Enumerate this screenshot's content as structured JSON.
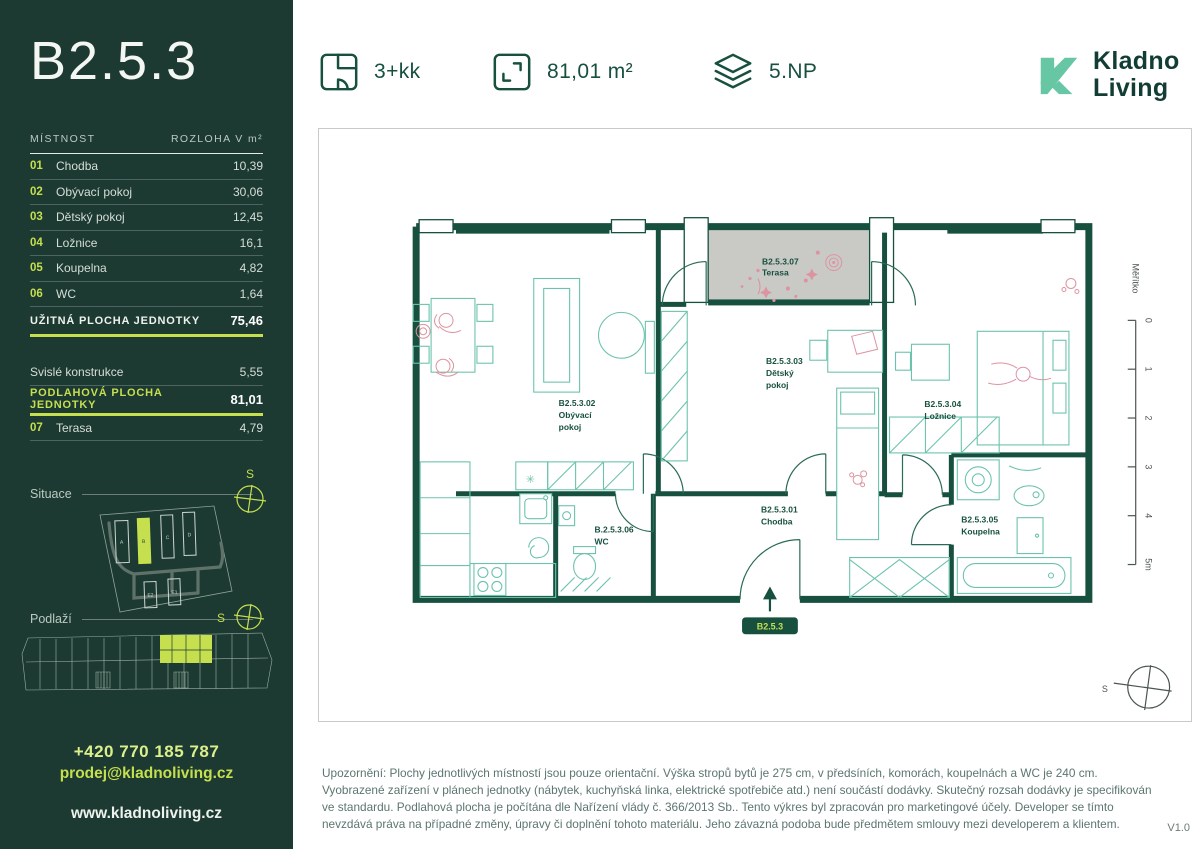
{
  "sidebar": {
    "unit_title": "B2.5.3",
    "table": {
      "col_room": "MÍSTNOST",
      "col_area": "ROZLOHA V m²",
      "rows": [
        {
          "num": "01",
          "name": "Chodba",
          "area": "10,39"
        },
        {
          "num": "02",
          "name": "Obývací pokoj",
          "area": "30,06"
        },
        {
          "num": "03",
          "name": "Dětský pokoj",
          "area": "12,45"
        },
        {
          "num": "04",
          "name": "Ložnice",
          "area": "16,1"
        },
        {
          "num": "05",
          "name": "Koupelna",
          "area": "4,82"
        },
        {
          "num": "06",
          "name": "WC",
          "area": "1,64"
        }
      ],
      "usable_label": "UŽITNÁ PLOCHA JEDNOTKY",
      "usable_value": "75,46",
      "walls_label": "Svislé konstrukce",
      "walls_value": "5,55",
      "floor_label": "PODLAHOVÁ PLOCHA JEDNOTKY",
      "floor_value": "81,01",
      "terrace_num": "07",
      "terrace_name": "Terasa",
      "terrace_value": "4,79"
    },
    "situace": {
      "label": "Situace",
      "compass": "S",
      "buildings": [
        {
          "label": "A"
        },
        {
          "label": "B"
        },
        {
          "label": "C"
        },
        {
          "label": "D"
        },
        {
          "label": "E2"
        },
        {
          "label": "E1"
        }
      ]
    },
    "podlazi": {
      "label": "Podlaží",
      "compass": "S"
    },
    "contact": {
      "phone": "+420 770 185 787",
      "email": "prodej@kladnoliving.cz",
      "web": "www.kladnoliving.cz"
    }
  },
  "header": {
    "specs": [
      {
        "icon": "layout-icon",
        "label": "3+kk"
      },
      {
        "icon": "area-icon",
        "label": "81,01 m²"
      },
      {
        "icon": "floors-icon",
        "label": "5.NP"
      }
    ],
    "logo_line1": "Kladno",
    "logo_line2": "Living"
  },
  "plan": {
    "rooms": [
      {
        "code": "B2.5.3.07",
        "line1": "Terasa",
        "line2": ""
      },
      {
        "code": "B2.5.3.02",
        "line1": "Obývací",
        "line2": "pokoj"
      },
      {
        "code": "B2.5.3.03",
        "line1": "Dětský",
        "line2": "pokoj"
      },
      {
        "code": "B2.5.3.04",
        "line1": "Ložnice",
        "line2": ""
      },
      {
        "code": "B2.5.3.01",
        "line1": "Chodba",
        "line2": ""
      },
      {
        "code": "B.2.5.3.06",
        "line1": "WC",
        "line2": ""
      },
      {
        "code": "B2.5.3.05",
        "line1": "Koupelna",
        "line2": ""
      }
    ],
    "badge": "B2.5.3",
    "scale": {
      "label": "Měřítko",
      "ticks": [
        "0",
        "1",
        "2",
        "3",
        "4",
        "5m"
      ]
    },
    "compass": "S"
  },
  "footer": {
    "disclaimer": "Upozornění: Plochy jednotlivých místností jsou pouze orientační. Výška stropů bytů je 275 cm, v předsíních, komorách, koupelnách a WC je 240 cm. Vyobrazené zařízení v plánech jednotky (nábytek, kuchyňská linka, elektrické spotřebiče atd.) není součástí dodávky. Skutečný rozsah dodávky je specifikován ve standardu. Podlahová plocha je počítána dle Nařízení vlády č. 366/2013 Sb.. Tento výkres byl zpracován pro marketingové účely. Developer se tímto nevzdává práva na případné změny, úpravy či doplnění tohoto materiálu. Jeho závazná podoba bude předmětem smlouvy mezi developerem a klientem.",
    "version": "V1.0"
  },
  "colors": {
    "accent": "#c6df4f",
    "sidebar_bg": "#1c3a31",
    "wall": "#17503f",
    "furniture": "#6cc3ad",
    "pink": "#dd93a0",
    "terrace_fill": "#c9c9c6",
    "logo_mark": "#67c6a3"
  }
}
